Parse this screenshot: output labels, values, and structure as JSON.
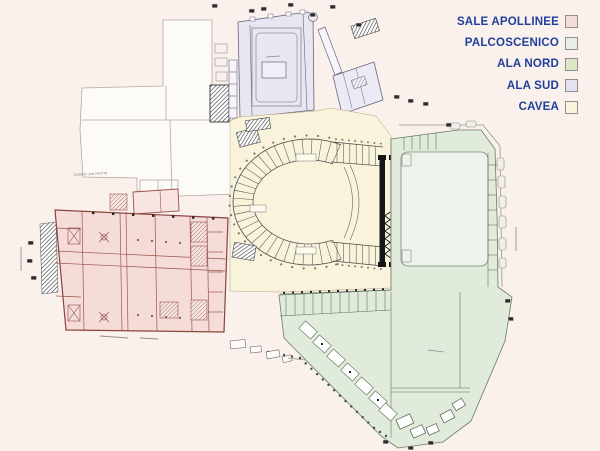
{
  "page": {
    "background": "#faf0ec",
    "unfilled_area_color": "#fdfbf8"
  },
  "legend": {
    "text_color": "#21409a",
    "items": [
      {
        "label": "SALE APOLLINEE",
        "color": "#f3dcd7"
      },
      {
        "label": "PALCOSCENICO",
        "color": "#e7ede9"
      },
      {
        "label": "ALA NORD",
        "color": "#dde7c6"
      },
      {
        "label": "ALA SUD",
        "color": "#e4e2f0"
      },
      {
        "label": "CAVEA",
        "color": "#f8f3da"
      }
    ]
  },
  "plan": {
    "regions": [
      {
        "id": "sale-apollinee",
        "label": "SALE APOLLINEE",
        "color": "#f5dcd8"
      },
      {
        "id": "palcoscenico",
        "label": "PALCOSCENICO",
        "color": "#eef2ec"
      },
      {
        "id": "ala-nord",
        "label": "ALA NORD",
        "color": "#e1ebdb"
      },
      {
        "id": "ala-sud",
        "label": "ALA SUD",
        "color": "#e8e6f0"
      },
      {
        "id": "cavea",
        "label": "CAVEA",
        "color": "#f8f3da"
      }
    ],
    "map_labels": [
      {
        "text": "CAMPO SAN FANTIN"
      }
    ]
  }
}
